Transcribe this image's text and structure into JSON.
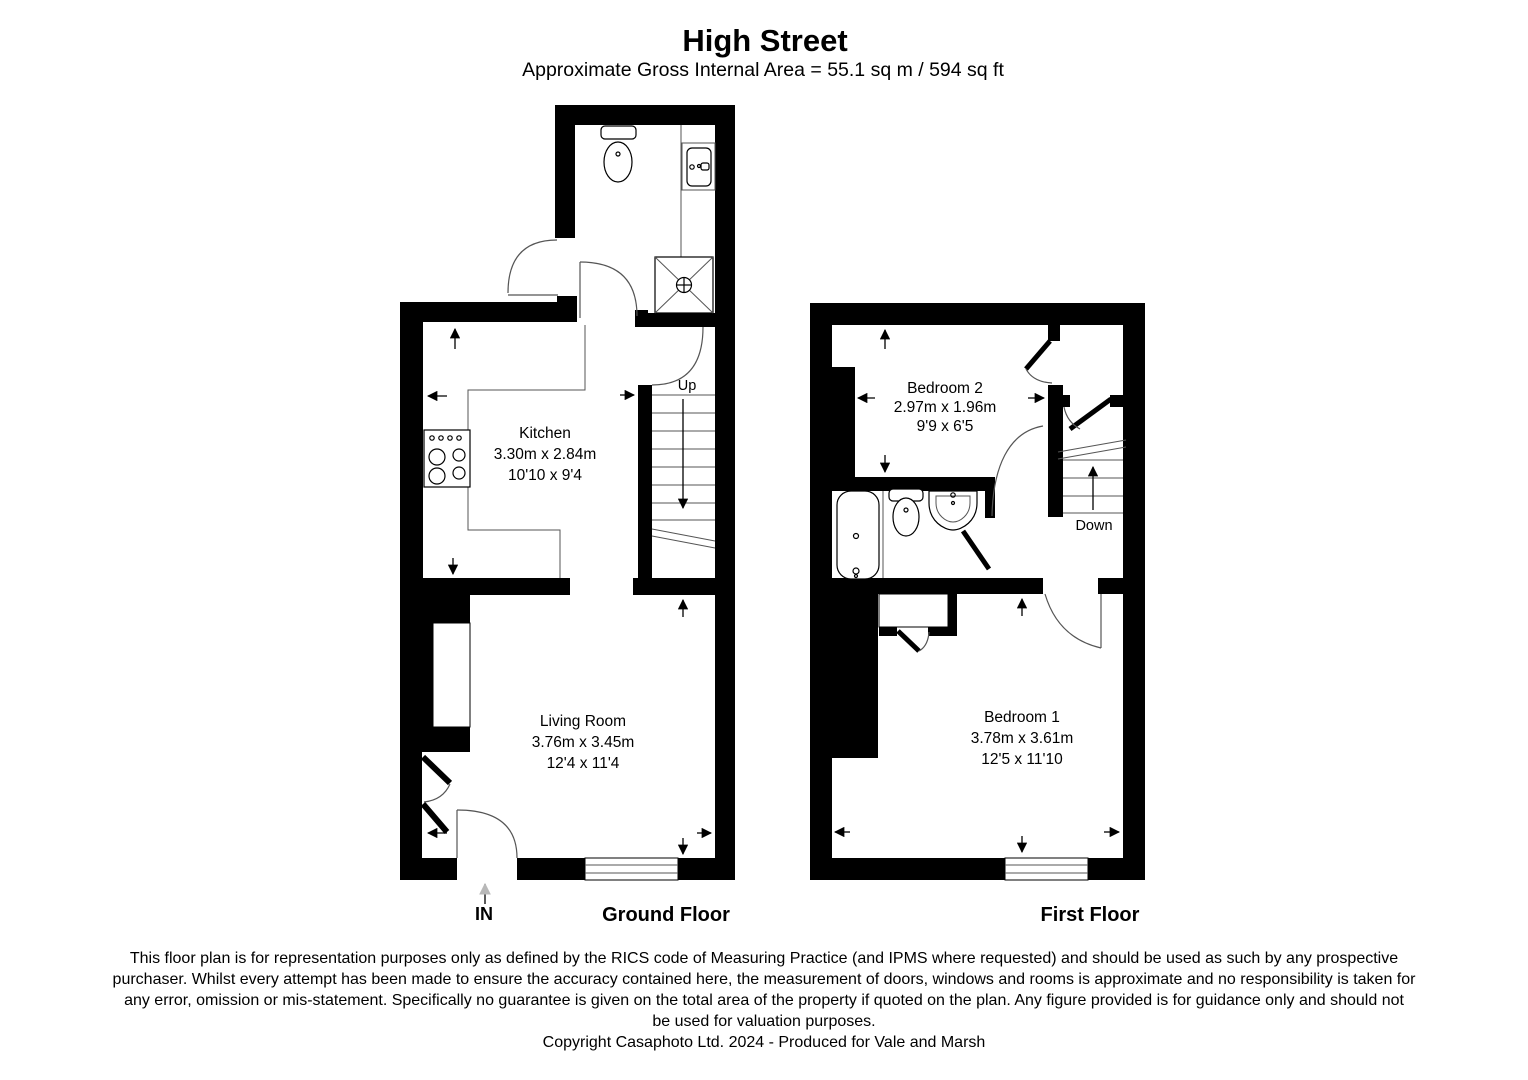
{
  "title": "High Street",
  "subtitle": "Approximate Gross Internal Area = 55.1 sq m / 594 sq ft",
  "ground_floor": {
    "label": "Ground Floor",
    "entrance_label": "IN",
    "stairs_label": "Up",
    "rooms": {
      "kitchen": {
        "name": "Kitchen",
        "size_metric": "3.30m x 2.84m",
        "size_imperial": "10'10 x 9'4"
      },
      "living_room": {
        "name": "Living Room",
        "size_metric": "3.76m x 3.45m",
        "size_imperial": "12'4 x 11'4"
      }
    }
  },
  "first_floor": {
    "label": "First Floor",
    "stairs_label": "Down",
    "rooms": {
      "bedroom_2": {
        "name": "Bedroom 2",
        "size_metric": "2.97m x 1.96m",
        "size_imperial": "9'9 x 6'5"
      },
      "bedroom_1": {
        "name": "Bedroom 1",
        "size_metric": "3.78m x 3.61m",
        "size_imperial": "12'5 x 11'10"
      }
    }
  },
  "footer": {
    "disclaimer_lines": [
      "This floor plan is for representation purposes only as defined by the RICS code of Measuring Practice (and IPMS where requested) and should be used as such by any prospective",
      "purchaser. Whilst every attempt has been made to ensure the accuracy contained here, the measurement of doors, windows and rooms is approximate and no responsibility is taken for",
      "any error, omission or mis-statement. Specifically no guarantee is given on the total area of the property if quoted on the plan. Any figure provided is for guidance only and should not",
      "be used for valuation purposes."
    ],
    "copyright": "Copyright Casaphoto Ltd. 2024 - Produced for Vale and Marsh"
  },
  "icons": [
    "toilet-icon",
    "sink-icon",
    "shower-icon",
    "bath-icon",
    "cooker-icon",
    "stairs-up-icon",
    "stairs-down-icon",
    "measurement-arrow-icon",
    "entrance-arrow-icon",
    "door-swing-icon",
    "window-icon"
  ],
  "colors": {
    "walls": "#000000",
    "thin_lines": "#555555",
    "text": "#000000",
    "entrance_arrow": "#b8b8b8",
    "background": "#ffffff"
  }
}
